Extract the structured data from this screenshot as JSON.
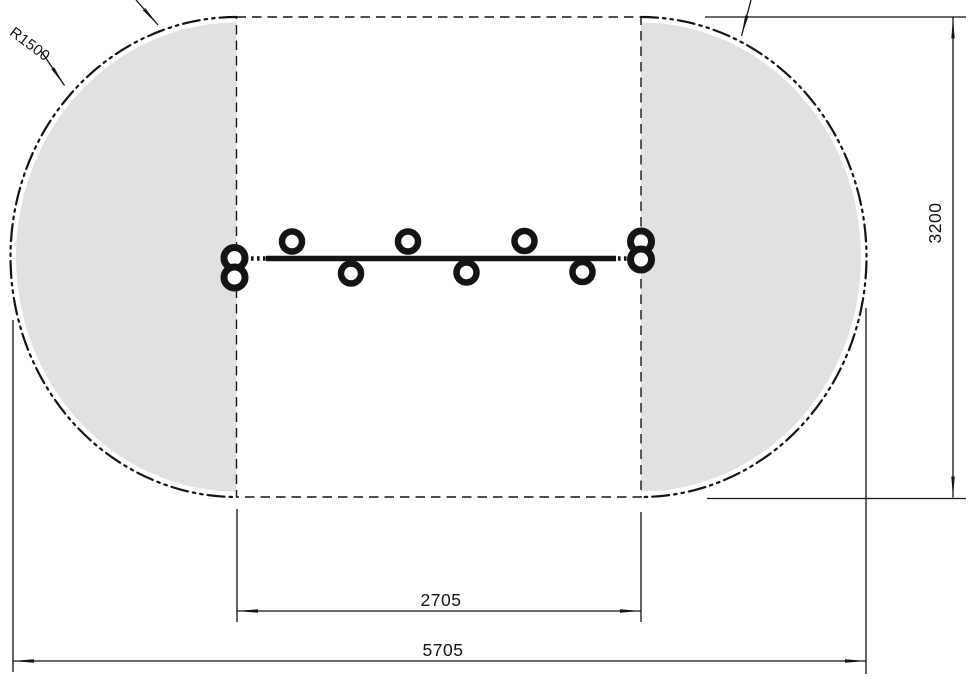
{
  "drawing": {
    "labels": {
      "radius": "R1500",
      "inner_width": "2705",
      "overall_width": "5705",
      "overall_height": "3200"
    },
    "colors": {
      "line": "#141414",
      "zone_fill": "#e2e1df",
      "background": "#ffffff"
    }
  }
}
